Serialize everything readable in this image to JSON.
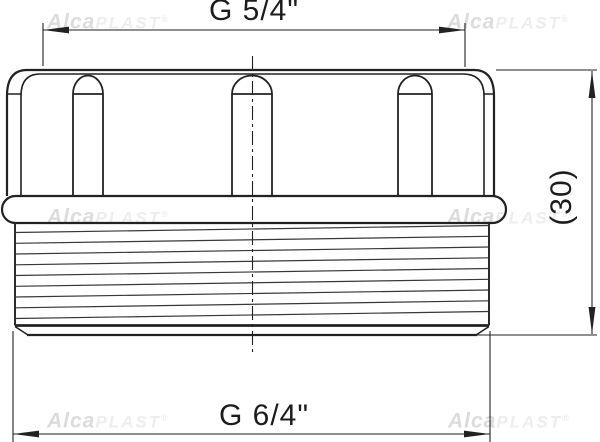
{
  "figure": {
    "type": "technical-drawing",
    "subject": "threaded-adapter-fitting",
    "dimensions": {
      "top_thread": "G 5/4\"",
      "bottom_thread": "G 6/4\"",
      "height_reference": "(30)"
    },
    "watermark": {
      "brand_bold": "Alca",
      "brand_light": "PLAST",
      "registered": "®"
    },
    "colors": {
      "outline": "#222222",
      "thread_line": "#383838",
      "dimension_line": "#222222",
      "text": "#1c1c1c",
      "watermark_bold": "#dcdcdc",
      "watermark_light": "#ededed",
      "background": "#ffffff"
    }
  }
}
